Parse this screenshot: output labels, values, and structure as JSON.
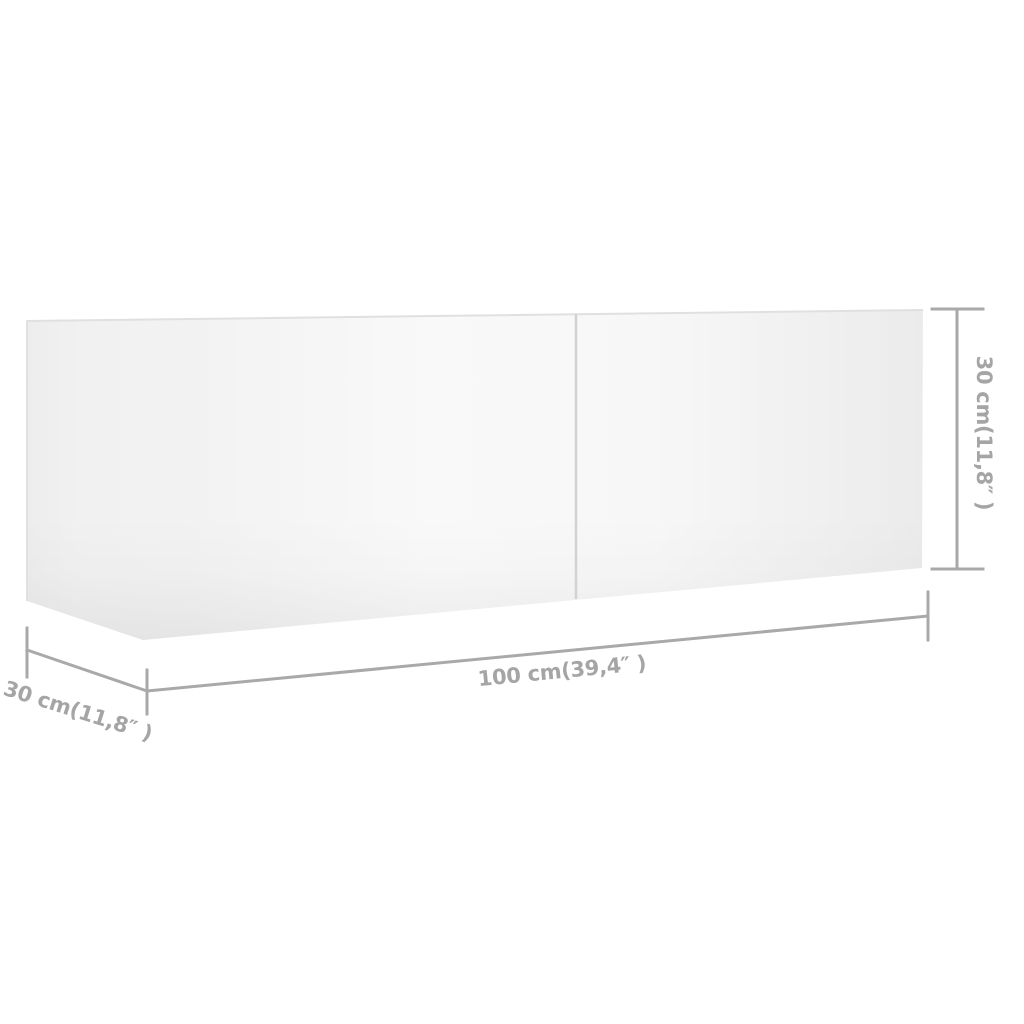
{
  "page": {
    "background_color": "#ffffff"
  },
  "diagram": {
    "type": "product-dimension-diagram",
    "subject": "white wall-mounted TV cabinet with two front panels, shown in slight perspective",
    "colors": {
      "dimension_line": "#a9a9a9",
      "label": "#a5a5a5",
      "divider": "#d2d2d2",
      "edge": "#e0e0e0"
    },
    "dimensions": {
      "width": {
        "label": "100 cm(39,4″ )",
        "cm": "100",
        "inches": "39,4"
      },
      "height": {
        "label": "30 cm(11,8″ )",
        "cm": "30",
        "inches": "11,8"
      },
      "depth": {
        "label": "30 cm(11,8″ )",
        "cm": "30",
        "inches": "11,8"
      }
    }
  }
}
